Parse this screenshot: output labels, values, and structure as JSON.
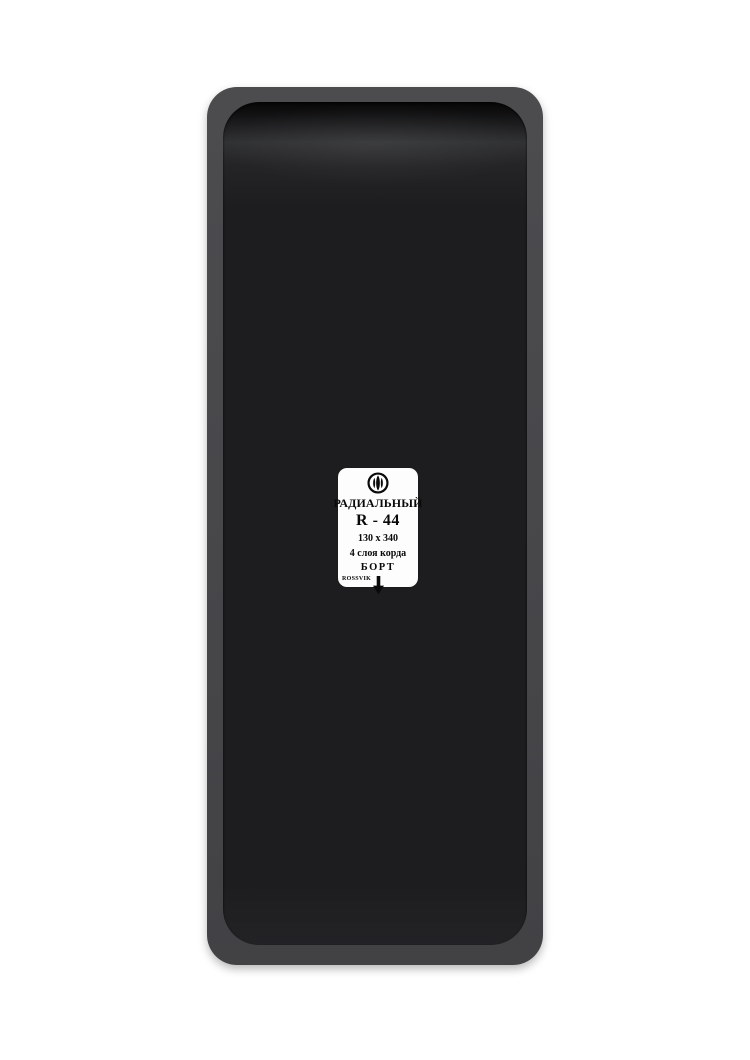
{
  "product": {
    "kind": "tire-repair-patch-photo"
  },
  "label": {
    "logo_icon": "rossvik-flower-in-circle",
    "type_text": "РАДИАЛЬНЫЙ",
    "model_text": "R - 44",
    "size_text": "130 x 340",
    "plies_text": "4 слоя корда",
    "bead_text": "БОРТ",
    "bead_arrow_icon": "down-arrow",
    "brand_text": "ROSSVIK"
  },
  "colors": {
    "edge": "#48484b",
    "edge_hi": "#4c4c4f",
    "edge_lo": "#424245",
    "face": "#1d1d1f",
    "label_bg": "#fdfdfd",
    "ink": "#0a0a0a"
  }
}
